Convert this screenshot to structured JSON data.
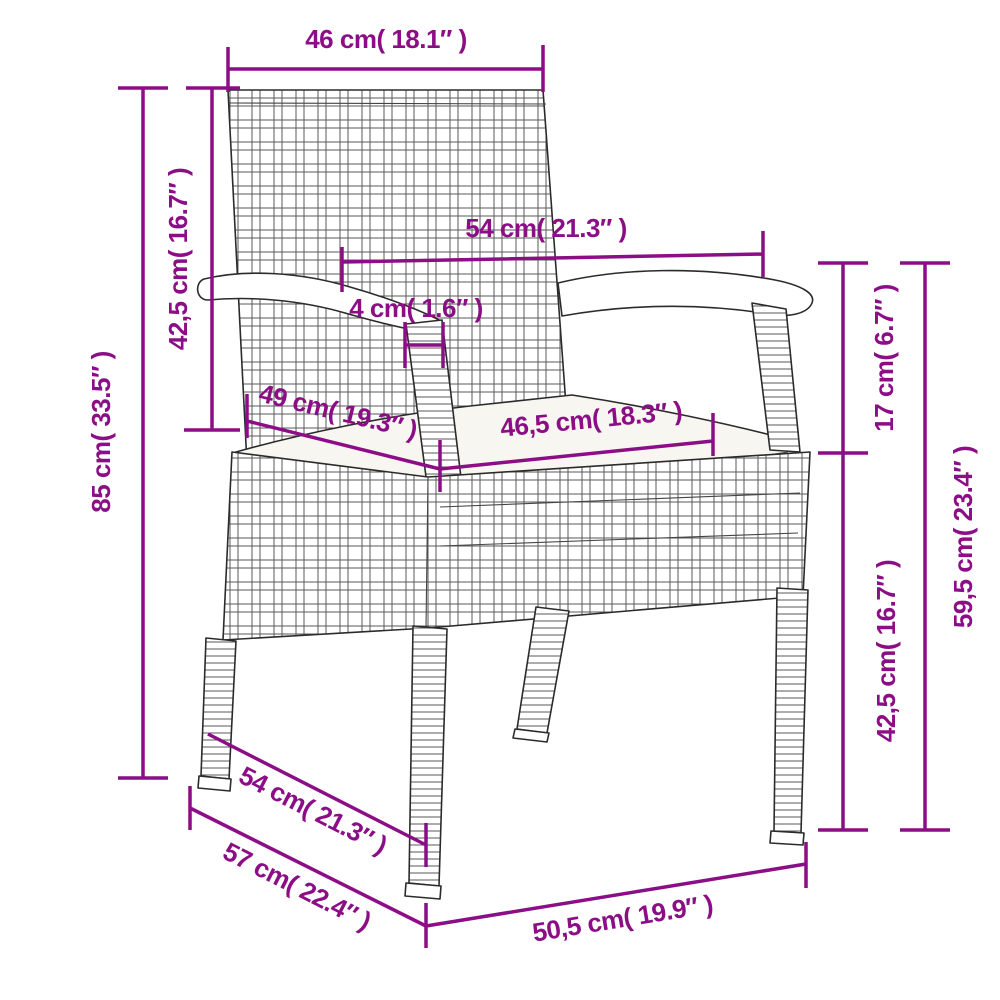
{
  "page": {
    "background": "#ffffff",
    "type": "product dimension diagram",
    "subject": "poly rattan garden chair with armrests and seat cushion",
    "view": "three-quarter line drawing"
  },
  "style": {
    "dimension_color": "#8C0E86",
    "line_art_color": "#2b2b2b",
    "cushion_fill": "#f8f6f1"
  },
  "dimensions": {
    "back_width": {
      "label": "46 cm( 18.1″ )",
      "cm": "46",
      "inches": "18.1"
    },
    "backrest_height": {
      "label": "42,5 cm( 16.7″ )",
      "cm": "42,5",
      "inches": "16.7"
    },
    "total_height": {
      "label": "85 cm( 33.5″ )",
      "cm": "85",
      "inches": "33.5"
    },
    "armrest_span": {
      "label": "54 cm( 21.3″ )",
      "cm": "54",
      "inches": "21.3"
    },
    "armrest_width": {
      "label": "4 cm( 1.6″ )",
      "cm": "4",
      "inches": "1.6"
    },
    "seat_depth": {
      "label": "49 cm( 19.3″ )",
      "cm": "49",
      "inches": "19.3"
    },
    "seat_width": {
      "label": "46,5 cm( 18.3″ )",
      "cm": "46,5",
      "inches": "18.3"
    },
    "seat_to_armrest": {
      "label": "17 cm( 6.7″ )",
      "cm": "17",
      "inches": "6.7"
    },
    "armrest_height": {
      "label": "59,5 cm( 23.4″ )",
      "cm": "59,5",
      "inches": "23.4"
    },
    "seat_height": {
      "label": "42,5 cm( 16.7″ )",
      "cm": "42,5",
      "inches": "16.7"
    },
    "depth_top": {
      "label": "54 cm( 21.3″ )",
      "cm": "54",
      "inches": "21.3"
    },
    "total_depth": {
      "label": "57 cm( 22.4″ )",
      "cm": "57",
      "inches": "22.4"
    },
    "base_front_width": {
      "label": "50,5 cm( 19.9″ )",
      "cm": "50,5",
      "inches": "19.9"
    }
  }
}
